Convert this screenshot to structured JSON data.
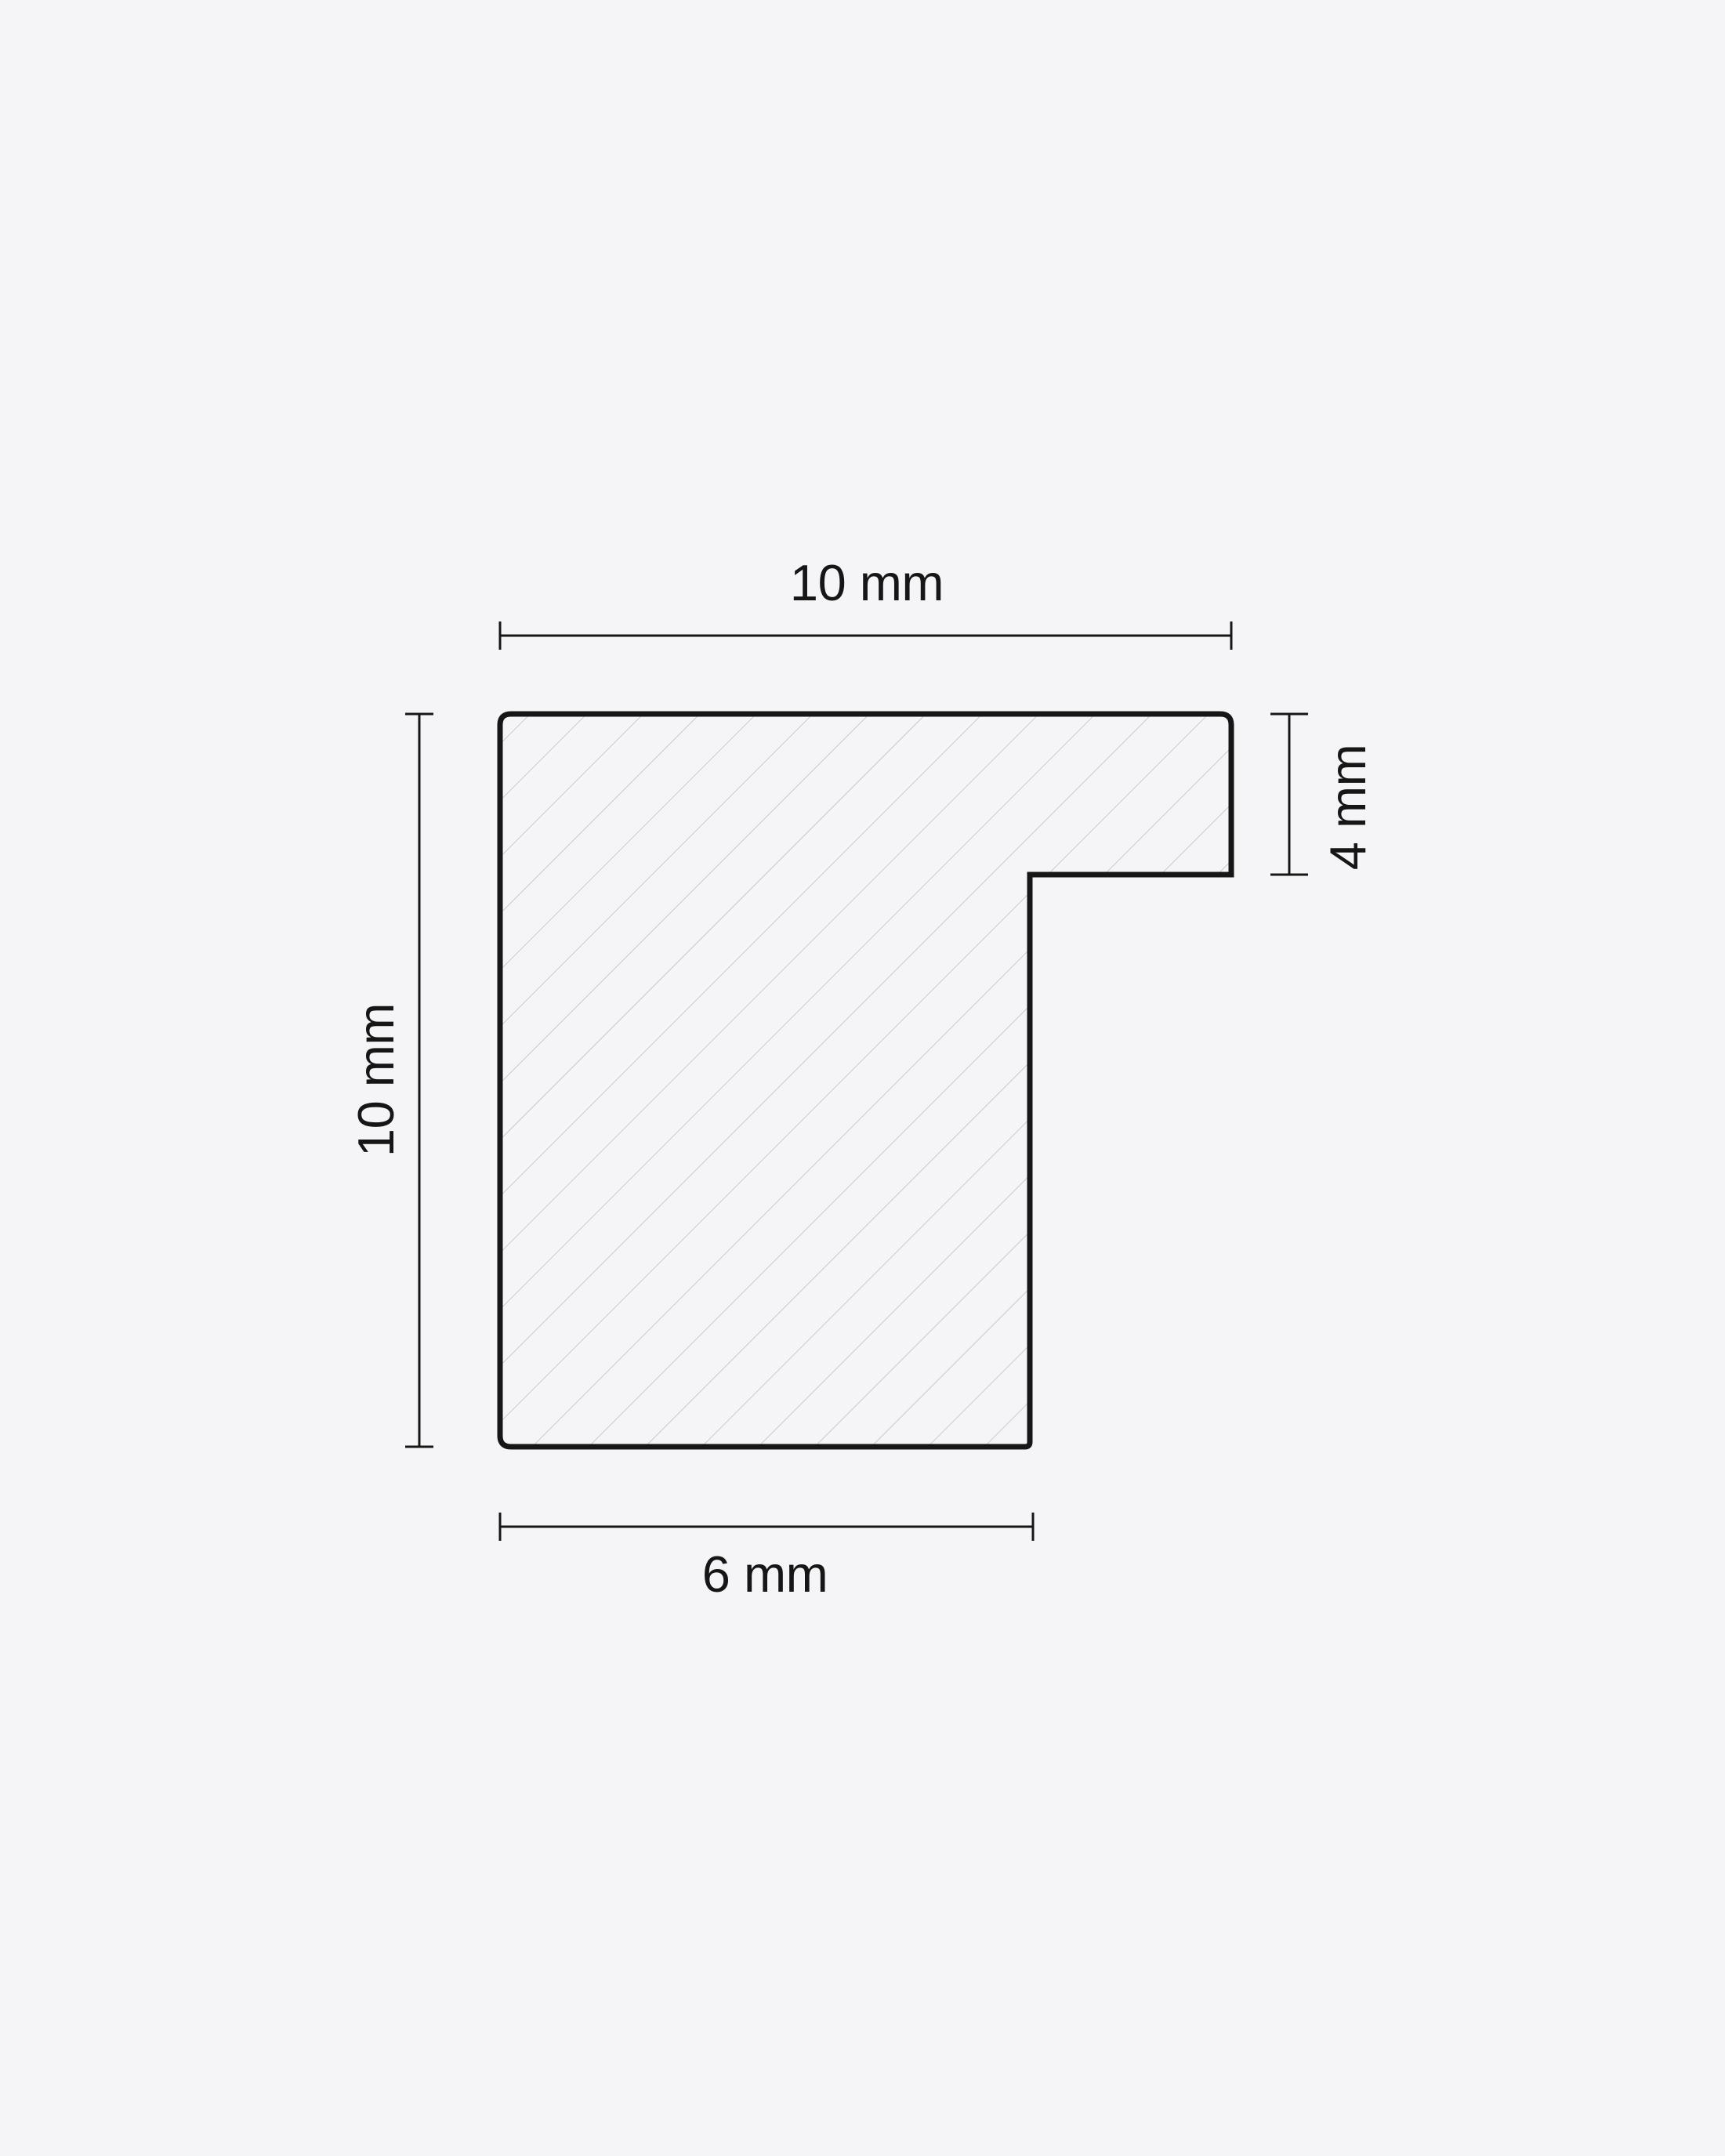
{
  "diagram": {
    "type": "technical-cross-section-profile",
    "description": "Hatched L-shaped moulding profile cross-section with four linear dimensions",
    "dimensions": {
      "top": {
        "label": "10 mm"
      },
      "left": {
        "label": "10 mm"
      },
      "right": {
        "label": "4 mm"
      },
      "bottom": {
        "label": "6 mm"
      }
    },
    "colors": {
      "background": "#f5f5f7",
      "outline": "#161616",
      "dimension_lines": "#161616",
      "text": "#161616",
      "hatch": "#c5c5c9"
    }
  }
}
